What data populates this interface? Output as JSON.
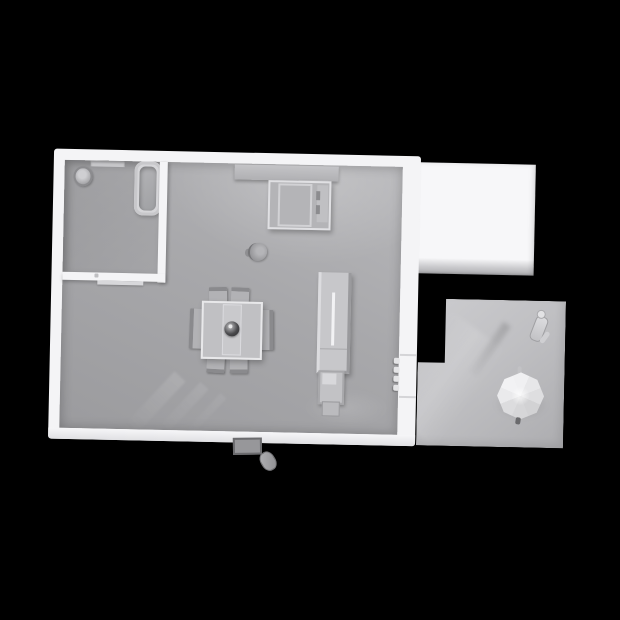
{
  "viewport": {
    "type": "3d-floorplan-render",
    "view": "top-down",
    "background": "#000000"
  },
  "colors": {
    "bg": "#000000",
    "wall": "#f4f4f6",
    "roof": "#f7f7f9",
    "floor": "#a8a8ab",
    "bath-floor": "#9e9ea1",
    "patio": "#c0c0c3",
    "furniture": "#bcbcbf",
    "furniture-dark": "#8a8a8d",
    "umbrella": "#e9e9eb",
    "bowl-dark": "#2e2e31"
  },
  "rooms": [
    {
      "name": "main-room"
    },
    {
      "name": "bathroom"
    },
    {
      "name": "roofed-annex"
    },
    {
      "name": "patio"
    }
  ],
  "objects": [
    {
      "name": "bathtub",
      "room": "bathroom"
    },
    {
      "name": "toilet",
      "room": "bathroom"
    },
    {
      "name": "wall-niche",
      "room": "bathroom"
    },
    {
      "name": "wall-shelf",
      "room": "main-room"
    },
    {
      "name": "desk-cabinet",
      "room": "main-room"
    },
    {
      "name": "dining-table",
      "room": "main-room",
      "chairs": 6
    },
    {
      "name": "centerpiece-bowl",
      "room": "main-room"
    },
    {
      "name": "floor-stool",
      "room": "main-room"
    },
    {
      "name": "tall-cabinet",
      "room": "main-room"
    },
    {
      "name": "cabinet-stool",
      "room": "main-room"
    },
    {
      "name": "patio-door-handle",
      "room": "main-room"
    },
    {
      "name": "doormat",
      "room": "exterior"
    },
    {
      "name": "shoe",
      "room": "exterior"
    },
    {
      "name": "parasol",
      "room": "patio"
    },
    {
      "name": "standing-figure",
      "room": "patio"
    }
  ]
}
